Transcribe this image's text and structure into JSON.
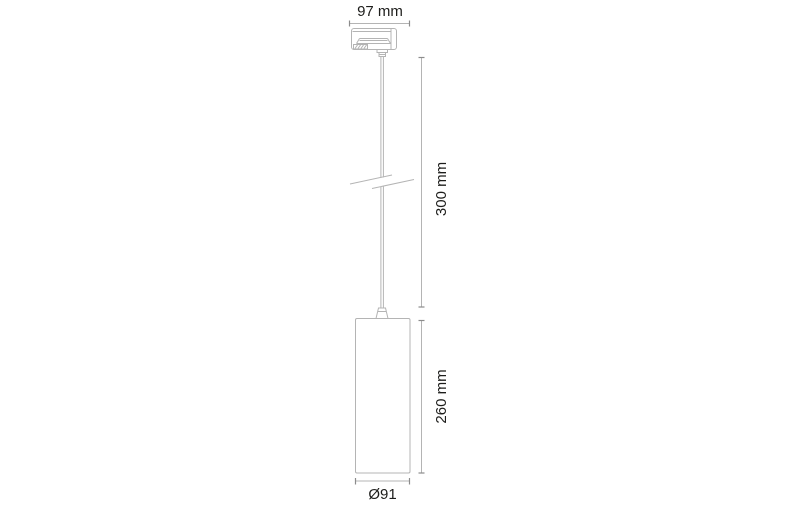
{
  "drawing": {
    "type": "technical-dimension-diagram",
    "subject": "pendant luminaire with 3-phase track adapter, suspension cable and cylindrical shade",
    "dimensions": {
      "adapter_width": "97 mm",
      "suspension_length": "300 mm",
      "body_height": "260 mm",
      "body_diameter": "Ø91"
    },
    "parts": [
      "track-adapter",
      "adapter-locking-nut",
      "suspension-cable",
      "cable-break-symbol",
      "cord-grip",
      "cylindrical-shade"
    ]
  },
  "colors": {
    "bg": "#ffffff",
    "line": "#b4b4b4",
    "dim-line": "#b4b4b4",
    "tick": "#8c8c8c",
    "text": "#1d1d1b"
  }
}
